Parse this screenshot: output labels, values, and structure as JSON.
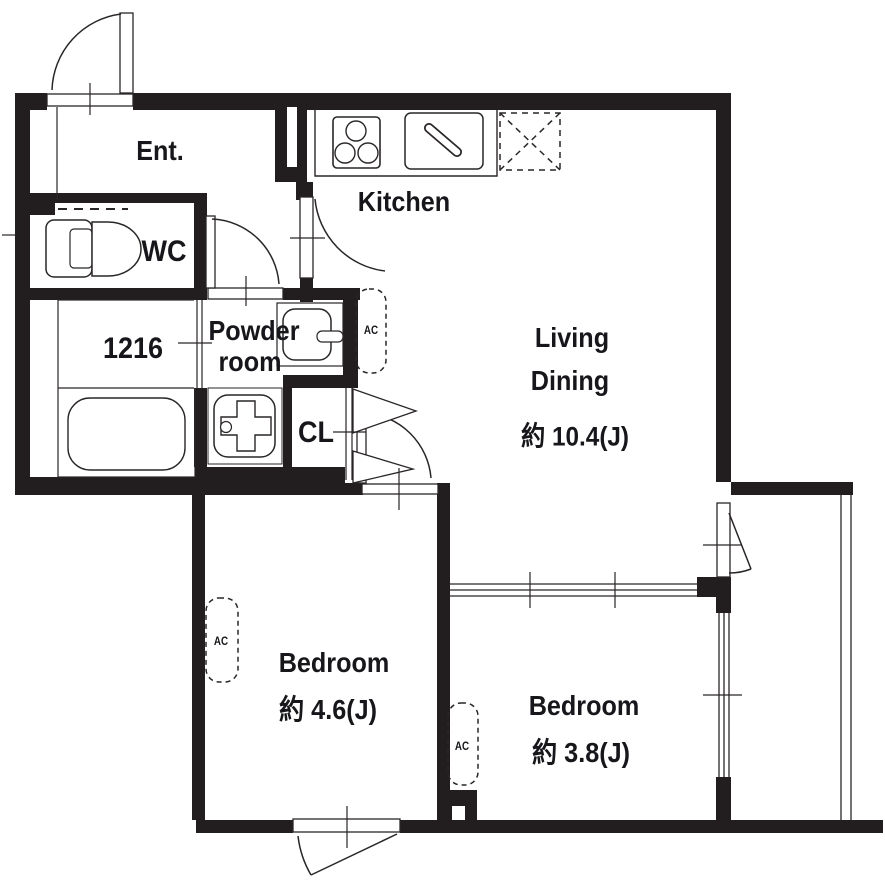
{
  "colors": {
    "wall": "#221e1f",
    "line": "#2a2627",
    "text": "#17161a",
    "background": "#ffffff"
  },
  "rooms": {
    "entrance": {
      "label": "Ent."
    },
    "wc": {
      "label": "WC"
    },
    "bathroom": {
      "size_label": "1216"
    },
    "powder_room": {
      "label_line1": "Powder",
      "label_line2": "room"
    },
    "kitchen": {
      "label": "Kitchen"
    },
    "living_dining": {
      "label_line1": "Living",
      "label_line2": "Dining",
      "area": "約 10.4(J)"
    },
    "closet": {
      "label": "CL"
    },
    "bedroom_46": {
      "label": "Bedroom",
      "area": "約 4.6(J)"
    },
    "bedroom_38": {
      "label": "Bedroom",
      "area": "約 3.8(J)"
    }
  },
  "equipment": {
    "ac_label": "AC"
  }
}
